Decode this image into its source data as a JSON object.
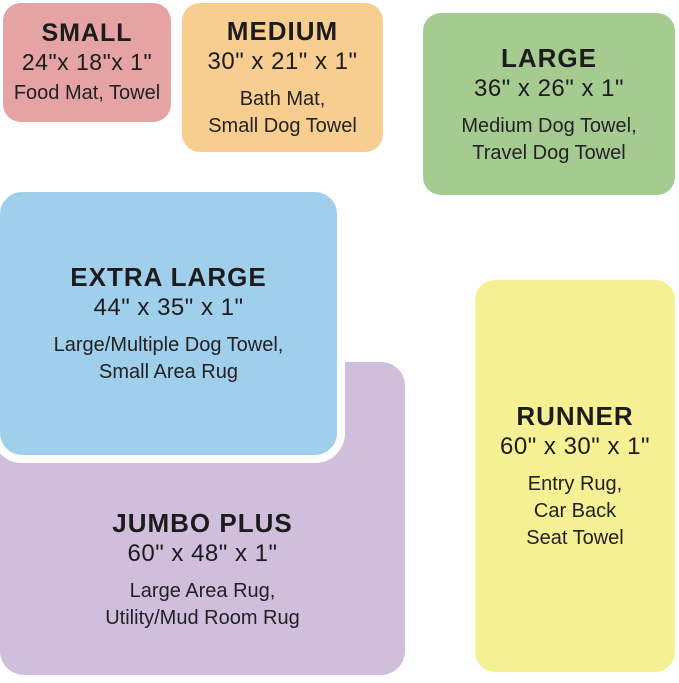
{
  "chart_title": "Size comparison chart",
  "text_color": "#1c1c1e",
  "background": "#ffffff",
  "cards": [
    {
      "id": "small",
      "title": "SMALL",
      "dimensions": "24\"x 18\"x 1\"",
      "uses": [
        "Food Mat, Towel"
      ],
      "color": "#e5a3a3"
    },
    {
      "id": "medium",
      "title": "MEDIUM",
      "dimensions": "30\" x 21\" x 1\"",
      "uses": [
        "Bath Mat,",
        "Small Dog Towel"
      ],
      "color": "#f8cd90"
    },
    {
      "id": "large",
      "title": "LARGE",
      "dimensions": "36\" x 26\" x 1\"",
      "uses": [
        "Medium Dog Towel,",
        "Travel Dog Towel"
      ],
      "color": "#a6cb90"
    },
    {
      "id": "extra-large",
      "title": "EXTRA LARGE",
      "dimensions": "44\" x 35\" x 1\"",
      "uses": [
        "Large/Multiple Dog Towel,",
        "Small Area Rug"
      ],
      "color": "#a0cfec",
      "outline_color": "#ffffff"
    },
    {
      "id": "jumbo-plus",
      "title": "JUMBO PLUS",
      "dimensions": "60\" x 48\" x 1\"",
      "uses": [
        "Large Area Rug,",
        "Utility/Mud Room Rug"
      ],
      "color": "#d0bedd"
    },
    {
      "id": "runner",
      "title": "RUNNER",
      "dimensions": "60\" x 30\" x 1\"",
      "uses": [
        "Entry Rug,",
        "Car Back",
        "Seat Towel"
      ],
      "color": "#f4f093"
    }
  ]
}
